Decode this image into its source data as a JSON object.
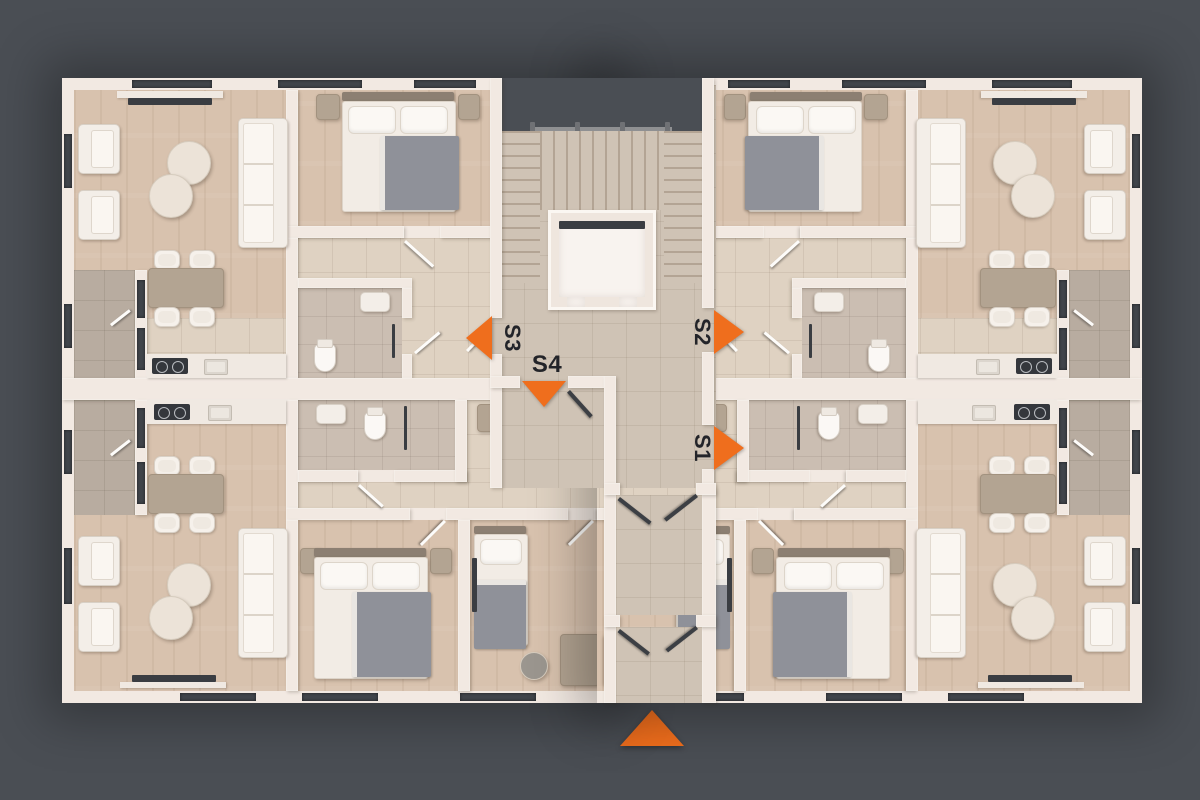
{
  "scene": {
    "type": "apartment-floor-plan",
    "units_marked": [
      "S1",
      "S2",
      "S3",
      "S4"
    ]
  },
  "palette": {
    "bg": "#4a4e54",
    "accent": "#ef6e1d",
    "wall": "#f2e9e2",
    "wood": "#d8c2ae",
    "tile": "#dfd2c2",
    "tileGray": "#cbbeb2",
    "tileCore": "#cfc3b5",
    "balcony": "#b8aca0",
    "window": "#41454b",
    "furn": "#f3eee8",
    "furnEdge": "#d8d0c6",
    "taupe": "#b3a492",
    "blanket": "#8f9199",
    "dark": "#3a3d42"
  },
  "markers": {
    "s1": {
      "label": "S1",
      "direction": "right"
    },
    "s2": {
      "label": "S2",
      "direction": "right"
    },
    "s3": {
      "label": "S3",
      "direction": "left"
    },
    "s4": {
      "label": "S4",
      "direction": "down"
    }
  },
  "compass": {
    "direction": "up"
  }
}
